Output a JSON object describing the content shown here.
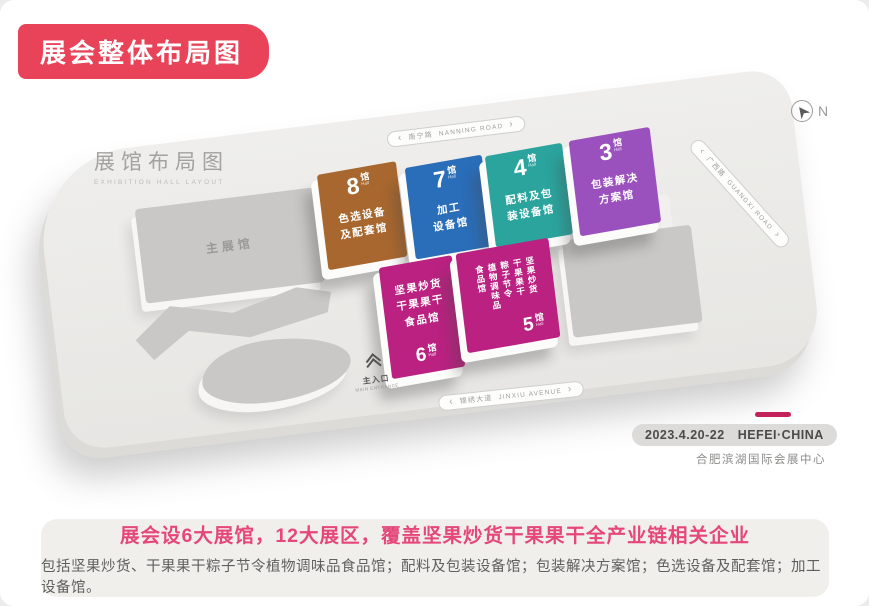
{
  "page_title": "展会整体布局图",
  "map": {
    "layout_title": "展馆布局图",
    "layout_subtitle": "EXHIBITION HALL LAYOUT",
    "compass_label": "N",
    "roads": {
      "north": {
        "cn": "南宁路",
        "en": "NANNING ROAD"
      },
      "east": {
        "cn": "广西路",
        "en": "GUANGXI ROAD"
      },
      "south": {
        "cn": "锦绣大道",
        "en": "JINXIU AVENUE"
      }
    },
    "main_hall_label": "主展馆",
    "entrance": {
      "label": "主入口",
      "sublabel": "MAIN ENTRANCE"
    },
    "halls": [
      {
        "number": "8",
        "suffix": "馆",
        "sub": "Hall",
        "lines": [
          "色选设备",
          "及配套馆"
        ],
        "color": "#a8672e"
      },
      {
        "number": "7",
        "suffix": "馆",
        "sub": "Hall",
        "lines": [
          "加工",
          "设备馆"
        ],
        "color": "#2a6db8"
      },
      {
        "number": "4",
        "suffix": "馆",
        "sub": "Hall",
        "lines": [
          "配料及包",
          "装设备馆"
        ],
        "color": "#2ba49e"
      },
      {
        "number": "3",
        "suffix": "馆",
        "sub": "Hall",
        "lines": [
          "包装解决",
          "方案馆"
        ],
        "color": "#9b51bd"
      },
      {
        "number": "6",
        "suffix": "馆",
        "sub": "Hall",
        "lines": [
          "坚果炒货",
          "干果果干",
          "食品馆"
        ],
        "color": "#ba2181"
      },
      {
        "number": "5",
        "suffix": "馆",
        "sub": "Hall",
        "lines": [
          "坚果炒货",
          "干果果干",
          "粽子节令",
          "植物调味品",
          "食品馆"
        ],
        "color": "#ba2181"
      }
    ]
  },
  "event": {
    "date": "2023.4.20-22",
    "location": "HEFEI·CHINA",
    "venue": "合肥滨湖国际会展中心"
  },
  "footer": {
    "headline": "展会设6大展馆，12大展区，覆盖坚果炒货干果果干全产业链相关企业",
    "detail": "包括坚果炒货、干果果干粽子节令植物调味品食品馆；配料及包装设备馆；包装解决方案馆；色选设备及配套馆；加工设备馆。"
  },
  "colors": {
    "banner": "#e94359",
    "headline": "#e5477a",
    "date_bar": "#c2215a",
    "hall_food": "#ba2181",
    "platform": "#ecebe9"
  }
}
